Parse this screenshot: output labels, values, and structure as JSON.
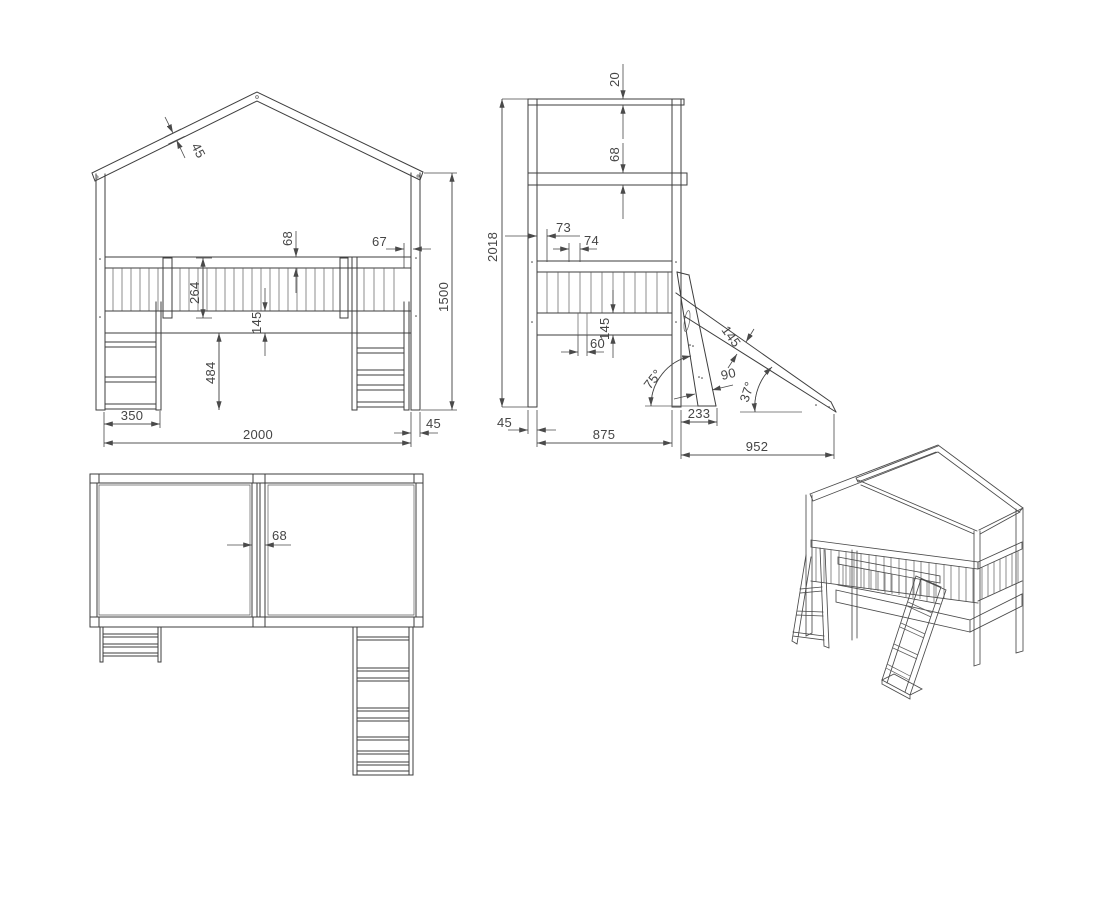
{
  "drawing": {
    "background_color": "#ffffff",
    "line_color": "#3e3e3e",
    "dimension_color": "#4a4a4a",
    "front_view": {
      "roof_board_thickness": "45",
      "top_rail_height": "68",
      "rail_end_offset": "67",
      "railing_height": "264",
      "bed_frame_height": "145",
      "under_bed_clearance": "484",
      "ladder_width": "350",
      "bed_length": "2000",
      "post_thickness": "45",
      "eave_height": "1500"
    },
    "side_view": {
      "ridge_board_thickness": "20",
      "eave_rail_height": "68",
      "overall_height": "2018",
      "first_slat_offset": "73",
      "slat_pitch": "74",
      "bed_frame_height": "145",
      "base_slat_width": "60",
      "ladder_angle": "75°",
      "ladder_board_width": "90",
      "slide_board_width": "145",
      "slide_angle": "37°",
      "post_thickness": "45",
      "bed_depth": "875",
      "ladder_foot_offset": "233",
      "slide_foot_offset": "952"
    },
    "top_view": {
      "center_beam_width": "68"
    }
  }
}
